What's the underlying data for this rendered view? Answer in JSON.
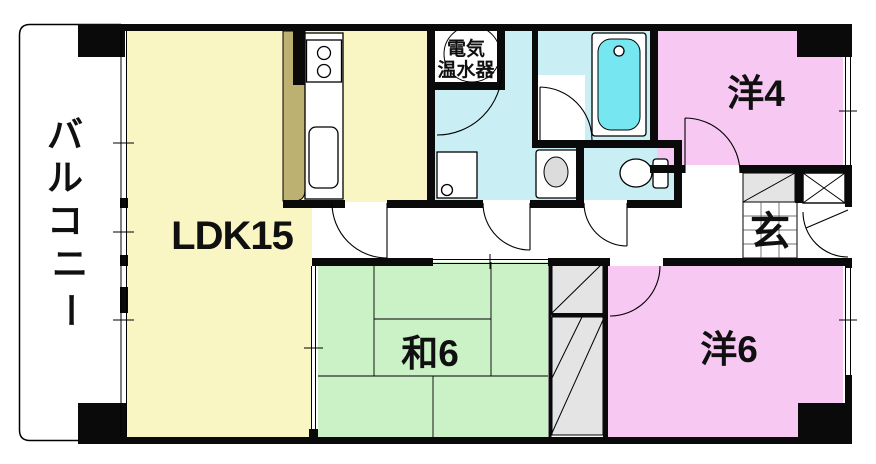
{
  "plan_title": "apartment-floor-plan",
  "colors": {
    "ldk": "#FAF6C3",
    "tatami": "#CBF1C6",
    "western": "#F7C8F2",
    "wet": "#C9EFF4",
    "tub": "#76E7F1",
    "counter": "#BCB170",
    "closet": "#E4E4E4",
    "fixture_gray": "#DCDCDC",
    "wall": "#0A0A0A"
  },
  "rooms": {
    "balcony": {
      "label": "バルコニー",
      "chars": [
        "バ",
        "ル",
        "コ",
        "ニ",
        "ー"
      ]
    },
    "ldk": {
      "label": "LDK15"
    },
    "japanese_room": {
      "label": "和6"
    },
    "western_room_4": {
      "label": "洋4"
    },
    "western_room_6": {
      "label": "洋6"
    },
    "entrance": {
      "label": "玄"
    },
    "water_heater": {
      "label_line1": "電気",
      "label_line2": "温水器"
    }
  }
}
